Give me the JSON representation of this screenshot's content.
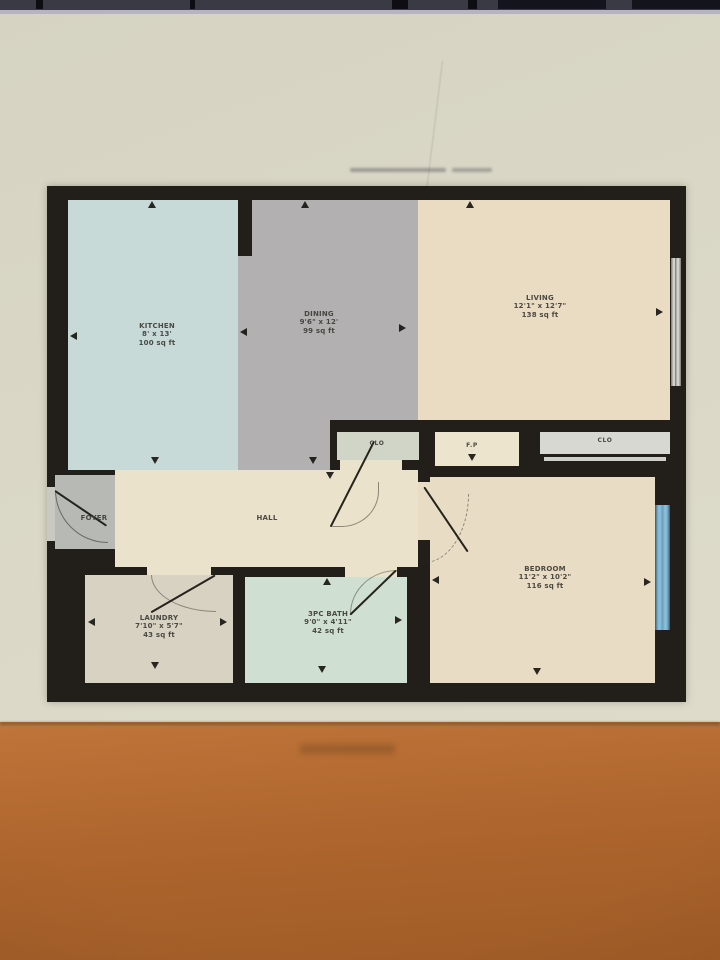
{
  "floorplan": {
    "title": "Apartment floor plan",
    "rooms": [
      {
        "id": "kitchen",
        "name": "KITCHEN",
        "dims": "8' x 13'",
        "area": "100 sq ft"
      },
      {
        "id": "dining",
        "name": "DINING",
        "dims": "9'6\" x 12'",
        "area": "99 sq ft"
      },
      {
        "id": "living",
        "name": "LIVING",
        "dims": "12'1\" x 12'7\"",
        "area": "138 sq ft"
      },
      {
        "id": "foyer",
        "name": "FOYER"
      },
      {
        "id": "hall",
        "name": "HALL"
      },
      {
        "id": "closet_left",
        "name": "CLO"
      },
      {
        "id": "fireplace",
        "name": "F.P"
      },
      {
        "id": "closet_right",
        "name": "CLO"
      },
      {
        "id": "laundry",
        "name": "LAUNDRY",
        "dims": "7'10\" x 5'7\"",
        "area": "43 sq ft"
      },
      {
        "id": "bath",
        "name": "3PC BATH",
        "dims": "9'0\" x 4'11\"",
        "area": "42 sq ft"
      },
      {
        "id": "bedroom",
        "name": "BEDROOM",
        "dims": "11'2\" x 10'2\"",
        "area": "116 sq ft"
      }
    ],
    "colors": {
      "wall": "#221f1a",
      "kitchen": "#c7dad8",
      "dining": "#b2b0b0",
      "living": "#e9dcc3",
      "hall": "#eae2cb",
      "foyer": "#b6b9b4",
      "closet_left": "#d1d5c7",
      "closet_right": "#d8d8d3",
      "fireplace_room": "#ede4cd",
      "laundry": "#d7d2c2",
      "bath": "#cfe0d2",
      "bedroom": "#e8dcc4",
      "window_blue": "#7fb1cd",
      "screen_background": "#d9d6c5",
      "desk_orange": "#b4692e"
    }
  }
}
